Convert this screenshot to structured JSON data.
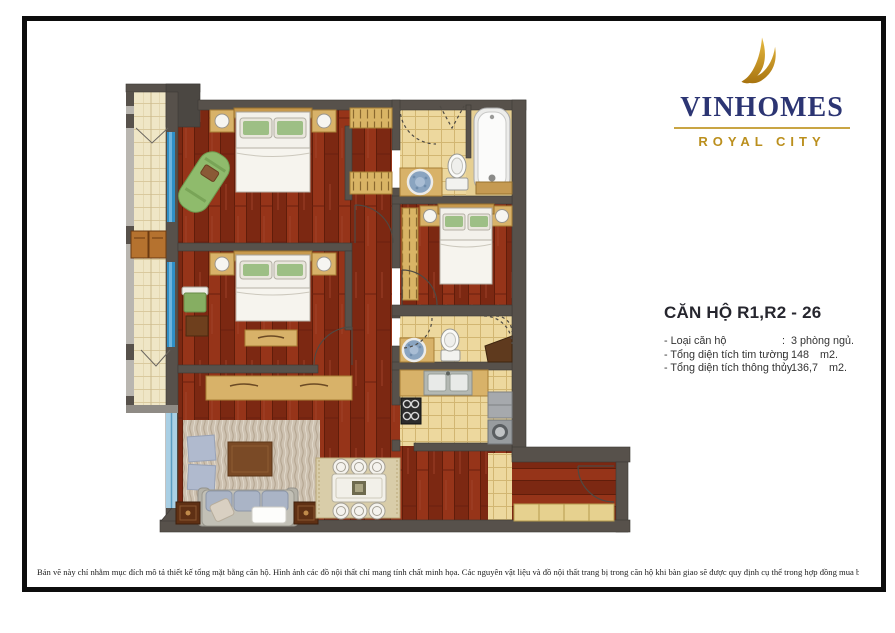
{
  "logo": {
    "brand": "VINHOMES",
    "subtitle": "ROYAL CITY",
    "bird_icon": "vinhomes-bird",
    "colors": {
      "navy": "#2c3573",
      "gold": "#bb8f1d",
      "rule_gold": "#c9a544"
    }
  },
  "info_panel": {
    "title": "CĂN HỘ R1,R2 - 26",
    "specs": [
      {
        "label": "- Loại căn hộ",
        "sep": ":",
        "value": "3 phòng ngủ.",
        "unit": ""
      },
      {
        "label": "- Tổng diện tích tim tường",
        "sep": ":",
        "value": "148",
        "unit": "m2."
      },
      {
        "label": "- Tổng diện tích thông thủy",
        "sep": ":",
        "value": "136,7",
        "unit": "m2."
      }
    ]
  },
  "disclaimer": "Bản vẽ này chỉ nhằm mục đích mô tả thiết kế tổng mặt bằng căn hộ. Hình ảnh các đồ nội thất chỉ mang tính chất minh họa. Các nguyên vật liệu và đồ nội thất trang bị trong căn hộ khi bàn giao sẽ được quy định cụ thể trong hợp đồng mua bán căn hộ.",
  "floorplan": {
    "colors": {
      "wall": "#57514b",
      "wood_floor": "#8c2f17",
      "tile_cream": "#efe6c6",
      "tile_tan": "#edd89e",
      "window_blue": "#2f8fc6",
      "furniture_tan": "#d8b269",
      "pillow_green": "#9dbf85",
      "sofa_gray_blue": "#aab4c6"
    }
  }
}
